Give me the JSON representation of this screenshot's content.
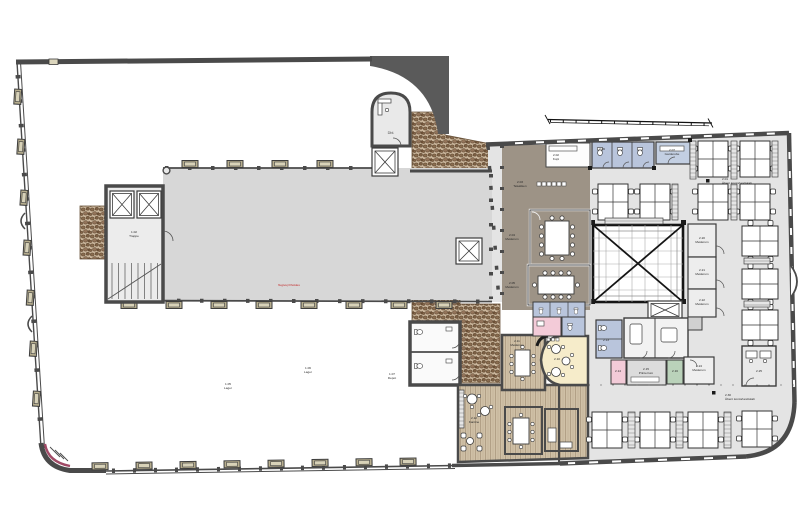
{
  "document": {
    "type": "architectural floor plan",
    "description": "Etageplan - pakhus med hal og kontorbygning med atrium",
    "red_note": "flugtvej friholdes"
  },
  "palette": {
    "wall": "#4a4a4a",
    "hall_floor": "#d7d7d7",
    "office_floor": "#e4e4e4",
    "meeting_zone_brown": "#9d9386",
    "wood_floor": "#cfc0a6",
    "cobble": "#c9b49a",
    "wet_room_blue": "#b9c5dc",
    "service_pink": "#f3cbd8",
    "store_green": "#bad2ba",
    "lounge_cream": "#f6ecca",
    "window_tan": "#b7ae8e",
    "accent_red": "#a04a66"
  },
  "labels": {
    "dbl": "Dbl.",
    "annex": {
      "no": "1.02",
      "name": "Trappe"
    },
    "open1": {
      "no": "1.05",
      "name": "Lager"
    },
    "open2": {
      "no": "1.06",
      "name": "Lager"
    },
    "open3": {
      "no": "1.07",
      "name": "Depot"
    },
    "kopi": {
      "no": "2.02",
      "name": "Kopi"
    },
    "tekokken": {
      "no": "2.03",
      "name": "Tekøkken"
    },
    "mode1": {
      "no": "2.04",
      "name": "Møderum"
    },
    "mode2": {
      "no": "2.05",
      "name": "Møderum"
    },
    "wc1": {
      "no": "2.06",
      "name": "Toilet"
    },
    "garderobe": {
      "no": "2.07",
      "name": "Garderobe"
    },
    "kontor_top": {
      "no": "2.01",
      "name": "Åbent kontorlandskab"
    },
    "lounge": {
      "no": "2.10",
      "name": "Lounge"
    },
    "mode3": {
      "no": "2.11",
      "name": "Møderum"
    },
    "kantine": {
      "no": "2.12",
      "name": "Kantine"
    },
    "wc2": {
      "no": "2.13",
      "name": "Toilet"
    },
    "reng": {
      "no": "2.14",
      "name": "Reng."
    },
    "printer": {
      "no": "2.15",
      "name": "Printerrum"
    },
    "depot": {
      "no": "2.16",
      "name": "Depot"
    },
    "mode4": {
      "no": "2.20",
      "name": "Møderum"
    },
    "mode5": {
      "no": "2.21",
      "name": "Møderum"
    },
    "mode6": {
      "no": "2.22",
      "name": "Møderum"
    },
    "mode7": {
      "no": "2.24",
      "name": "Møderum"
    },
    "kontor_sm": {
      "no": "2.25",
      "name": "Kontor"
    },
    "kontor_bund": {
      "no": "2.30",
      "name": "Åbent kontorlandskab"
    }
  }
}
